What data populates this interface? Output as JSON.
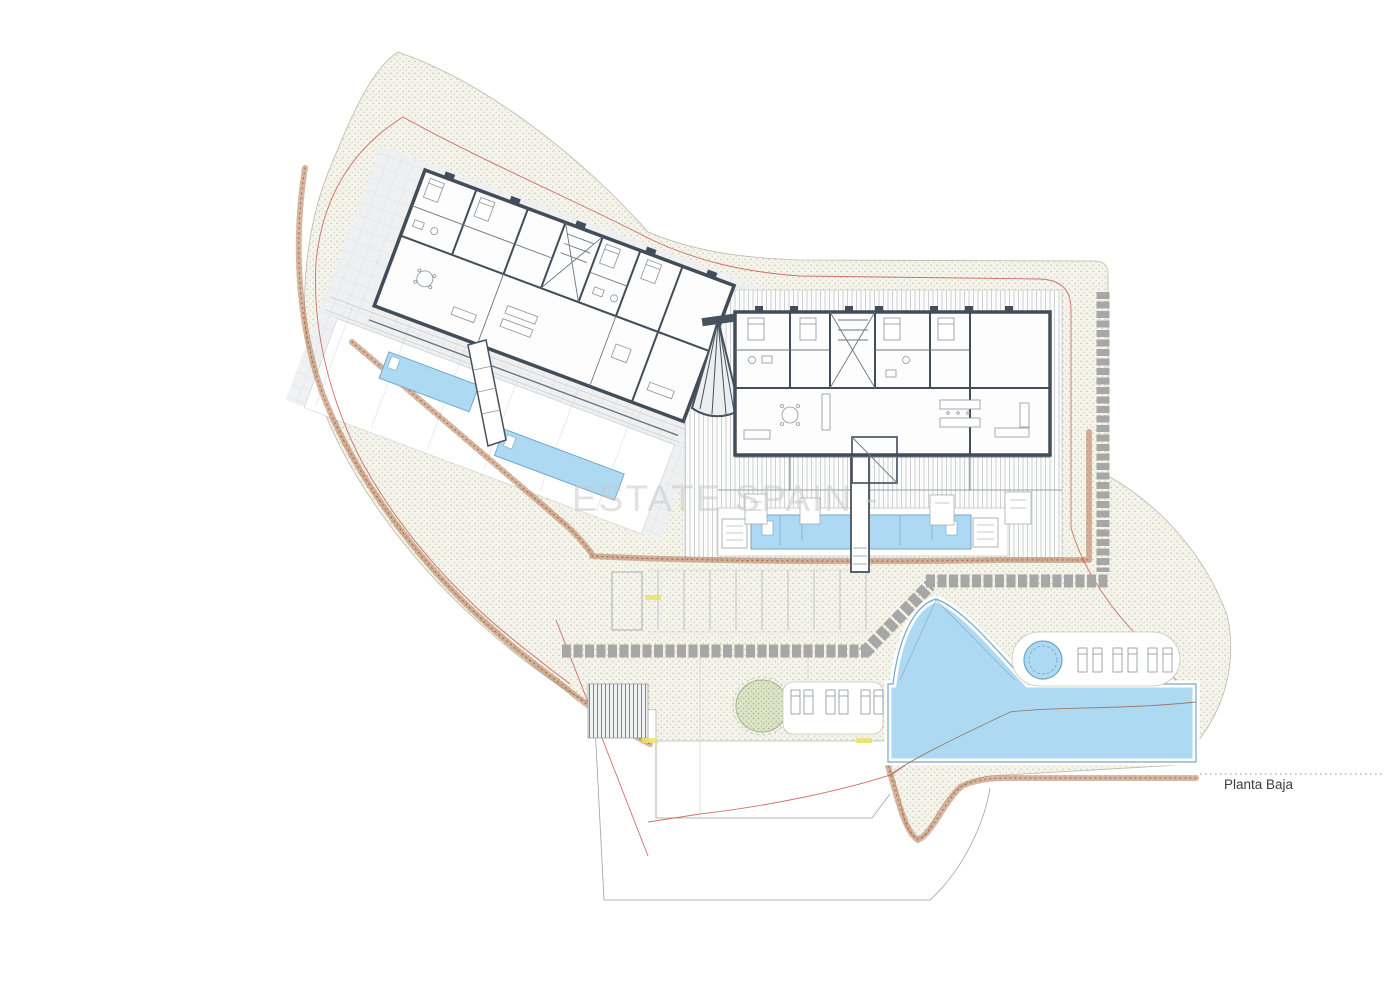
{
  "document": {
    "type": "architectural-site-plan",
    "floor_label": "Planta Baja",
    "watermark": "ESTATE SPAIN -"
  },
  "palette": {
    "pool_fill": "#aed9f2",
    "pool_edge": "#74a8c8",
    "wall_dark": "#414d59",
    "site_dots": "#d3d0b6",
    "rock_border": "#a9623e",
    "boundary_red": "#c0504a",
    "path_gray": "#a7a7a5",
    "tree_fill": "#cdd8b4",
    "marker_yellow": "#e9e469",
    "watermark_gray": "#c9c9c9"
  },
  "features": {
    "buildings": 2,
    "linear_private_pools": 3,
    "main_free_form_pool": 1,
    "spa_circular_pool": 1,
    "sun_loungers": 12,
    "parking_stalls": 9,
    "trees": 1,
    "exterior_staircases": 1
  }
}
